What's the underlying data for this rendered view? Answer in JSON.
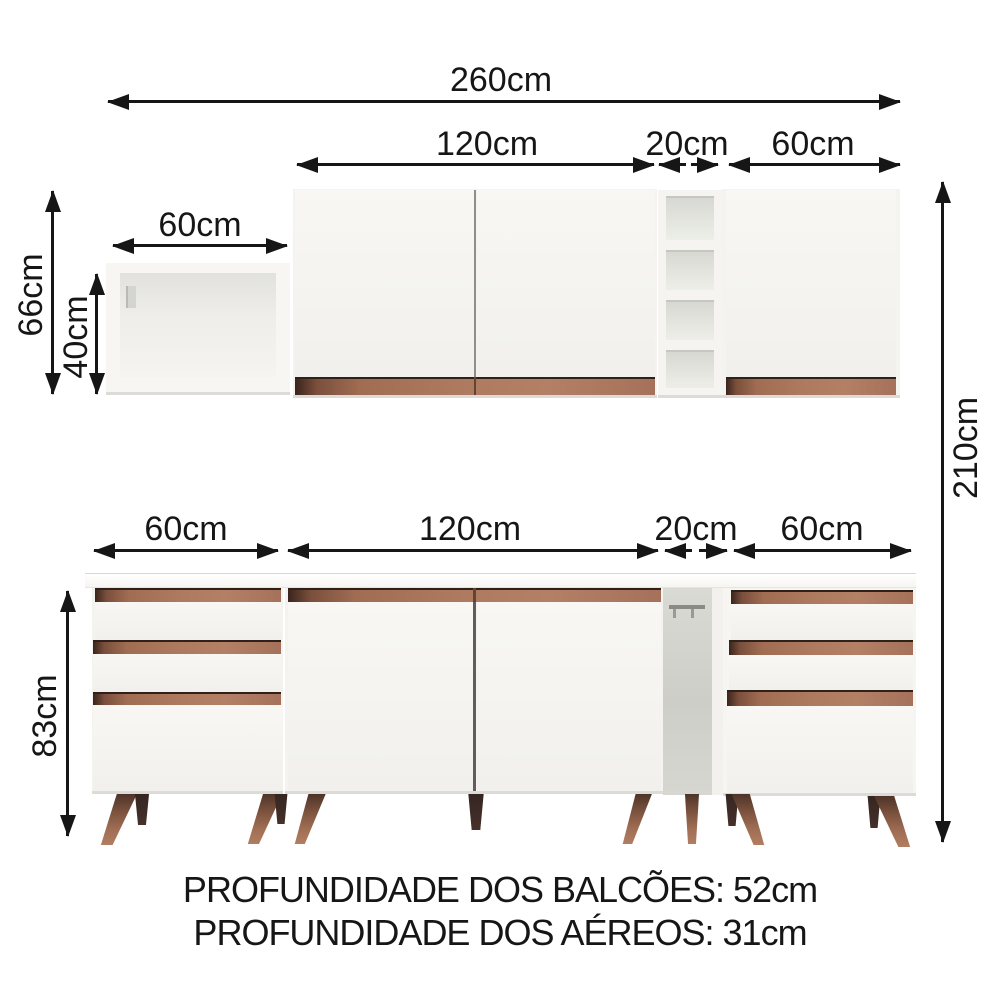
{
  "labels": {
    "w260": "260cm",
    "w120_top": "120cm",
    "w20_top": "20cm",
    "w60_top": "60cm",
    "w60_small": "60cm",
    "h66": "66cm",
    "h40": "40cm",
    "h210": "210cm",
    "w60_bottom_left": "60cm",
    "w120_bottom": "120cm",
    "w20_bottom": "20cm",
    "w60_bottom_right": "60cm",
    "h83": "83cm"
  },
  "footer": {
    "line1": "PROFUNDIDADE DOS BALCÕES: 52cm",
    "line2": "PROFUNDIDADE DOS AÉREOS: 31cm"
  },
  "colors": {
    "accent_wood": "#a8735a",
    "leg_wood": "#8a5d46",
    "cabinet_white": "#f5f4f0",
    "arrow_black": "#161616"
  }
}
